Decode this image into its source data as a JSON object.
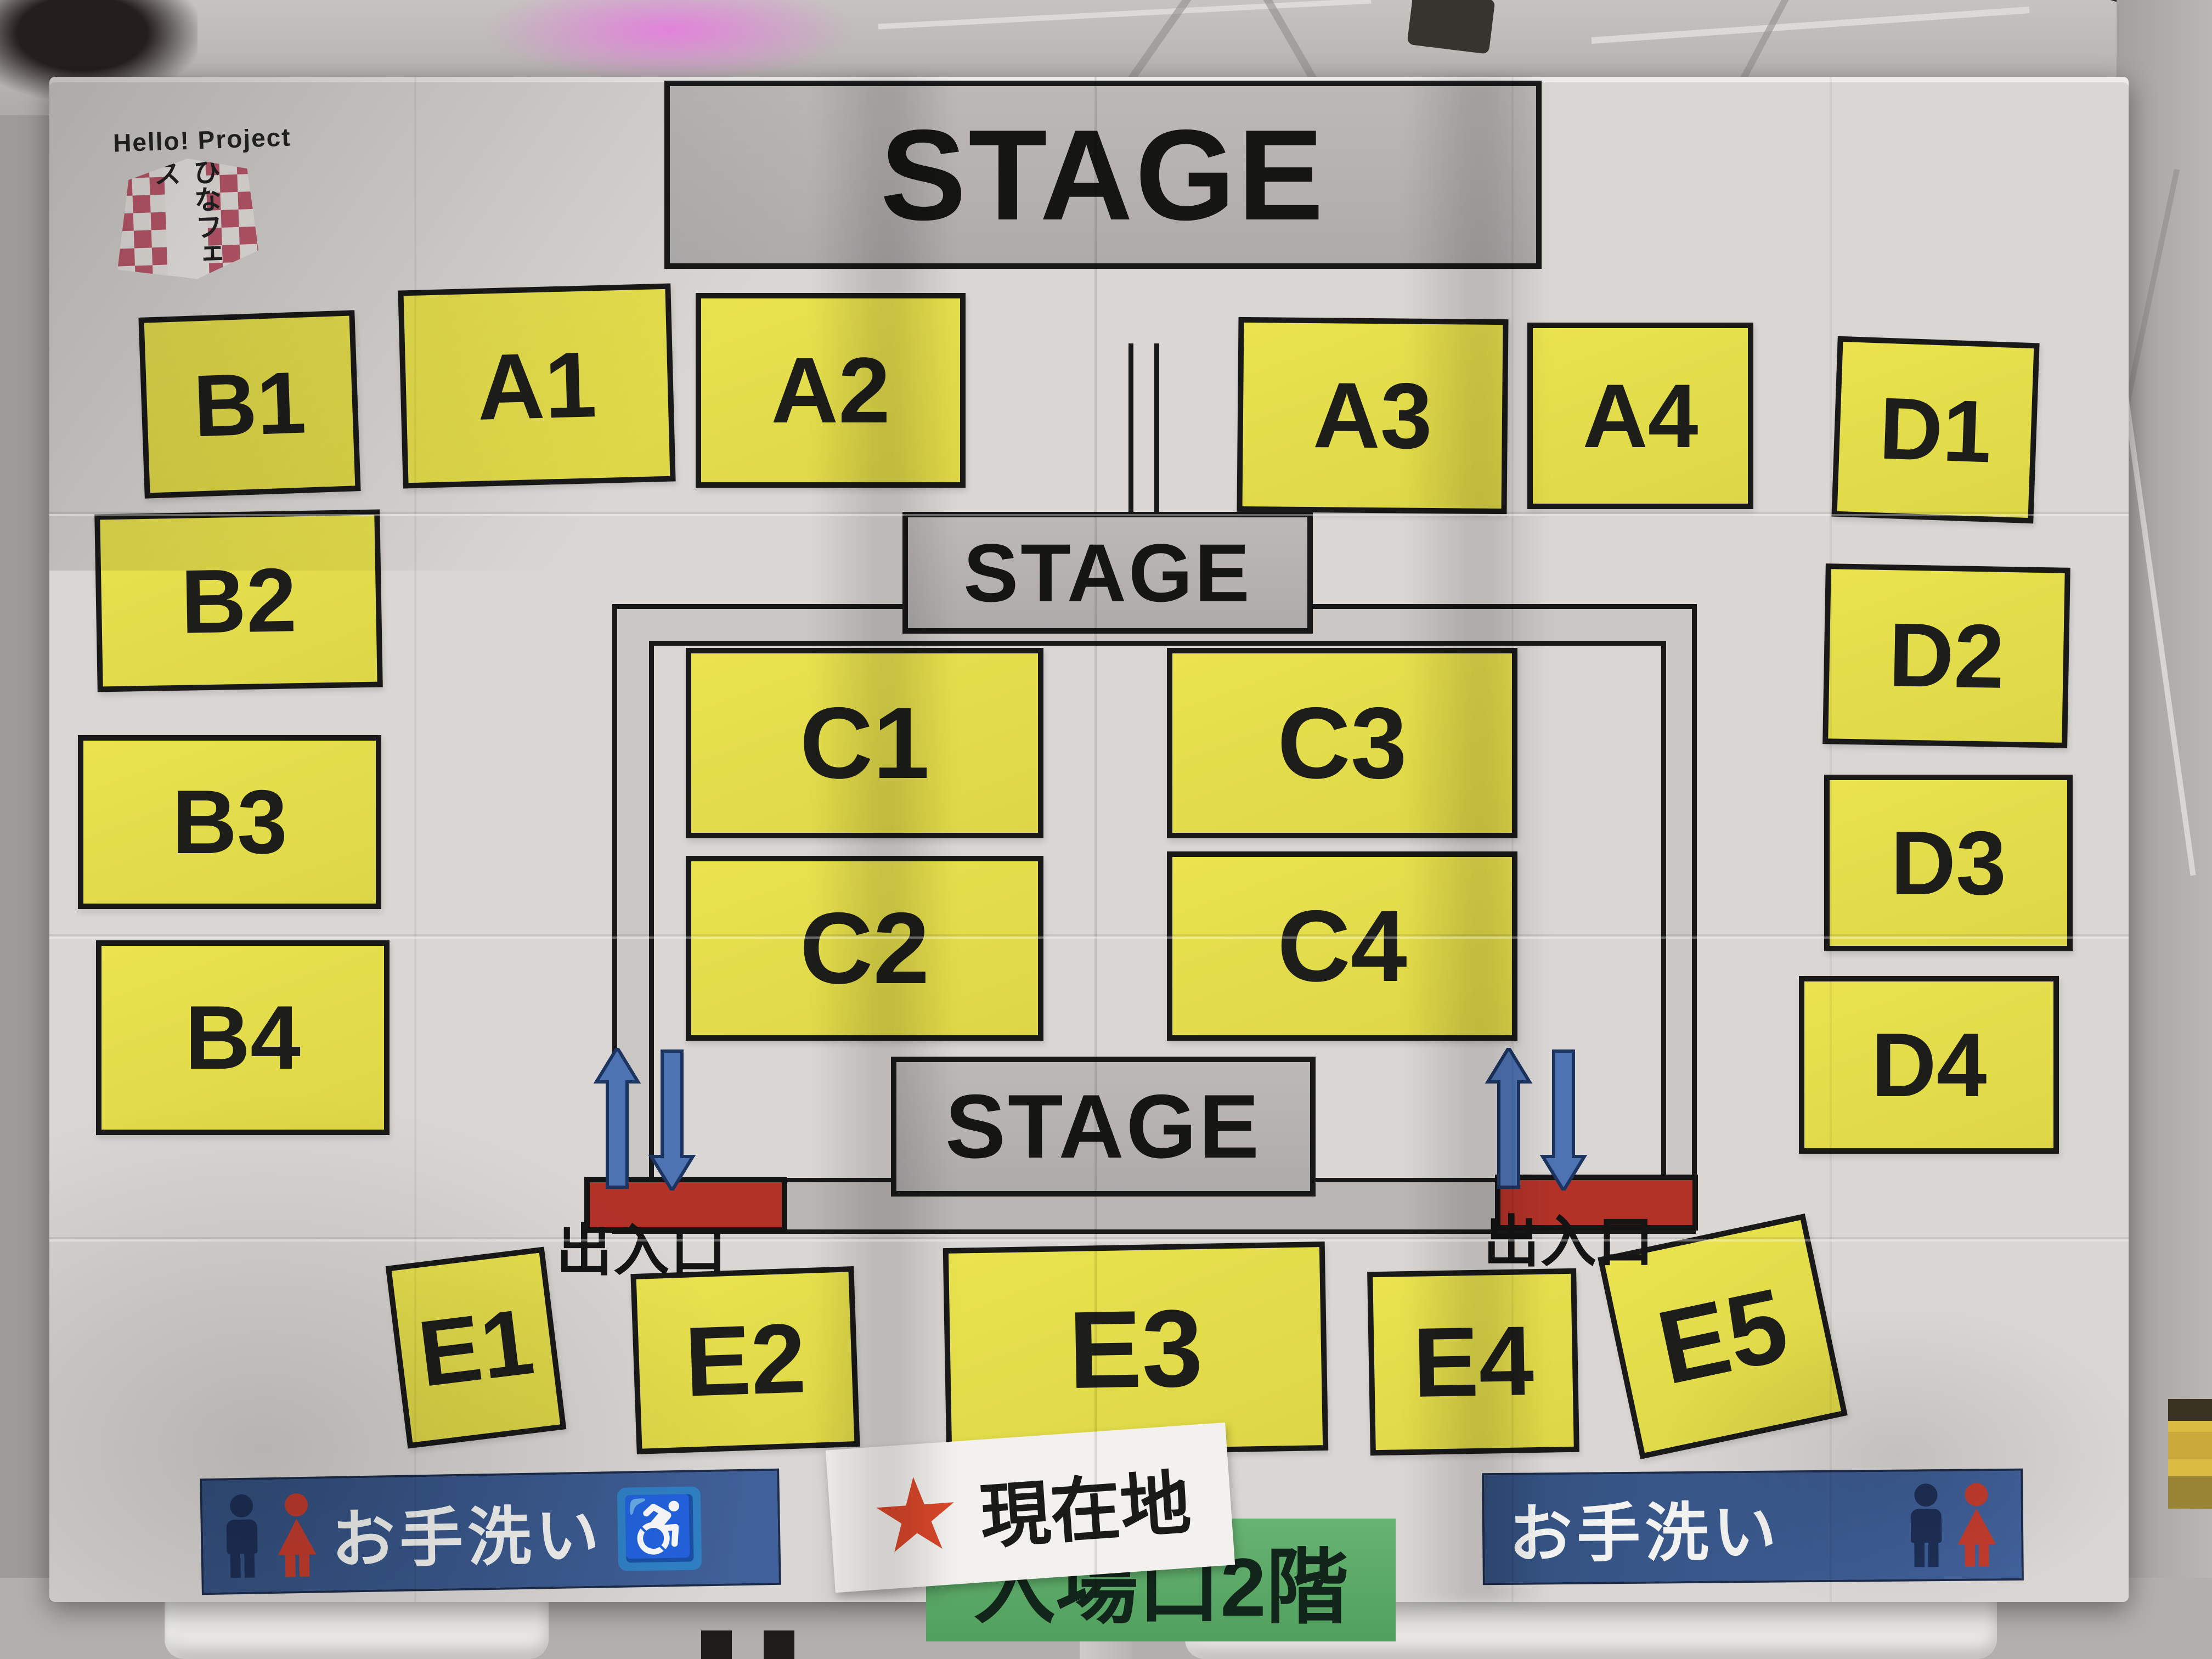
{
  "logo": {
    "brand": "Hello! Project",
    "event": "ひなフェス"
  },
  "stages": {
    "top": "STAGE",
    "center": "STAGE",
    "bottom": "STAGE"
  },
  "blocks": {
    "A1": "A1",
    "A2": "A2",
    "A3": "A3",
    "A4": "A4",
    "B1": "B1",
    "B2": "B2",
    "B3": "B3",
    "B4": "B4",
    "C1": "C1",
    "C2": "C2",
    "C3": "C3",
    "C4": "C4",
    "D1": "D1",
    "D2": "D2",
    "D3": "D3",
    "D4": "D4",
    "E1": "E1",
    "E2": "E2",
    "E3": "E3",
    "E4": "E4",
    "E5": "E5"
  },
  "gates": {
    "left": "出入口",
    "right": "出入口"
  },
  "signs": {
    "current_location": {
      "star": "★",
      "label": "現在地"
    },
    "entrance": "入場口2階",
    "restroom_left": "お手洗い",
    "restroom_right": "お手洗い",
    "wheelchair_glyph": "♿"
  },
  "icons": {
    "male": "male-person-icon",
    "female": "female-person-icon",
    "wheelchair": "wheelchair-icon",
    "arrows": "two-way-arrows-icon",
    "star": "current-location-star-icon"
  },
  "colors": {
    "seat_yellow": "#e6df4e",
    "stage_gray": "#b5b2af",
    "gate_red": "#b23228",
    "arrow_blue": "#4e73b2",
    "restroom_blue": "#3a5787",
    "entrance_green": "#5cab68",
    "star_red": "#d9472b"
  }
}
